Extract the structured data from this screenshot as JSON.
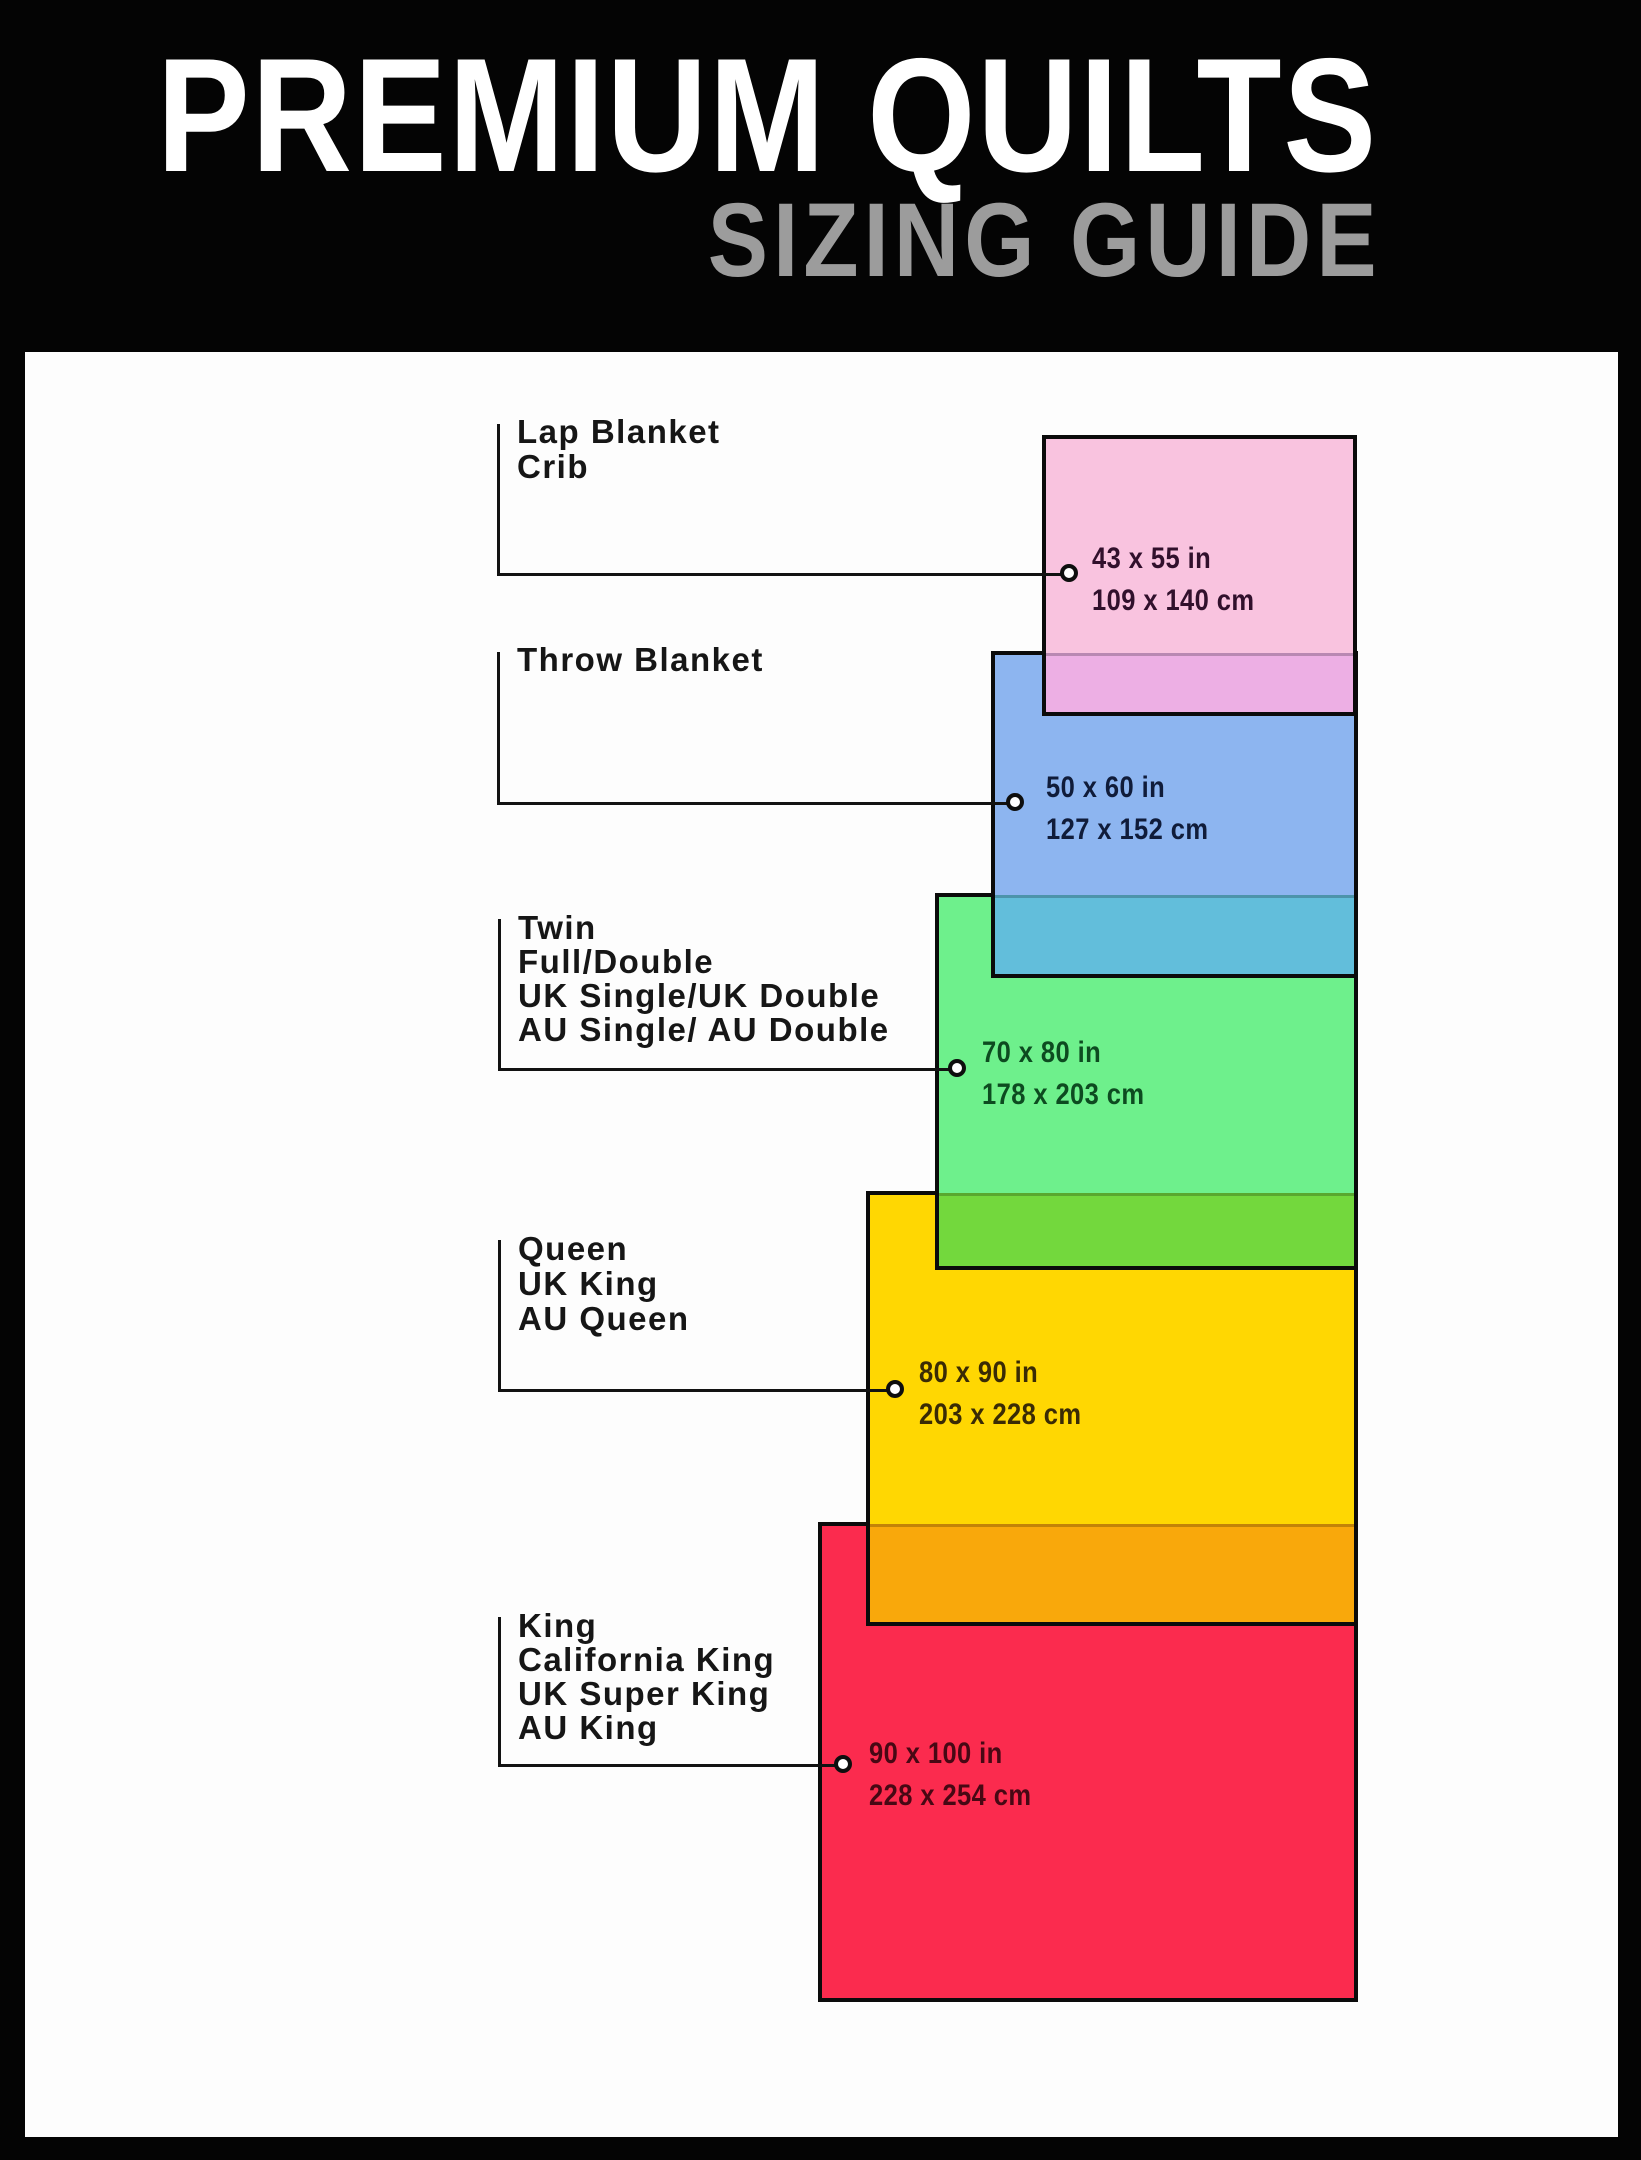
{
  "header": {
    "title": "PREMIUM QUILTS",
    "subtitle": "SIZING GUIDE"
  },
  "sizes": [
    {
      "id": "lap-blanket-crib",
      "names": [
        "Lap Blanket",
        "Crib"
      ],
      "inches": "43 x 55 in",
      "cm": "109 x 140 cm",
      "fill_color": "#f9c3df",
      "overlap_band_color": "#edafe4",
      "measure_text_color": "#31102c"
    },
    {
      "id": "throw-blanket",
      "names": [
        "Throw Blanket"
      ],
      "inches": "50 x 60 in",
      "cm": "127 x 152 cm",
      "fill_color": "#8db5f0",
      "overlap_band_color": "#62bedb",
      "measure_text_color": "#101c3a"
    },
    {
      "id": "twin-full-double",
      "names": [
        "Twin",
        "Full/Double",
        "UK Single/UK Double",
        "AU Single/ AU Double"
      ],
      "inches": "70 x 80 in",
      "cm": "178 x 203 cm",
      "fill_color": "#6ef08c",
      "overlap_band_color": "#73d83d",
      "measure_text_color": "#0d4b20"
    },
    {
      "id": "queen-uk-king",
      "names": [
        "Queen",
        "UK King",
        "AU Queen"
      ],
      "inches": "80 x 90 in",
      "cm": "203 x 228 cm",
      "fill_color": "#ffd702",
      "overlap_band_color": "#f9a80b",
      "measure_text_color": "#3a2b05"
    },
    {
      "id": "king-california-king",
      "names": [
        "King",
        "California King",
        "UK Super King",
        "AU King"
      ],
      "inches": "90 x 100 in",
      "cm": "228 x 254 cm",
      "fill_color": "#fb2b4e",
      "overlap_band_color": null,
      "measure_text_color": "#470814"
    }
  ]
}
